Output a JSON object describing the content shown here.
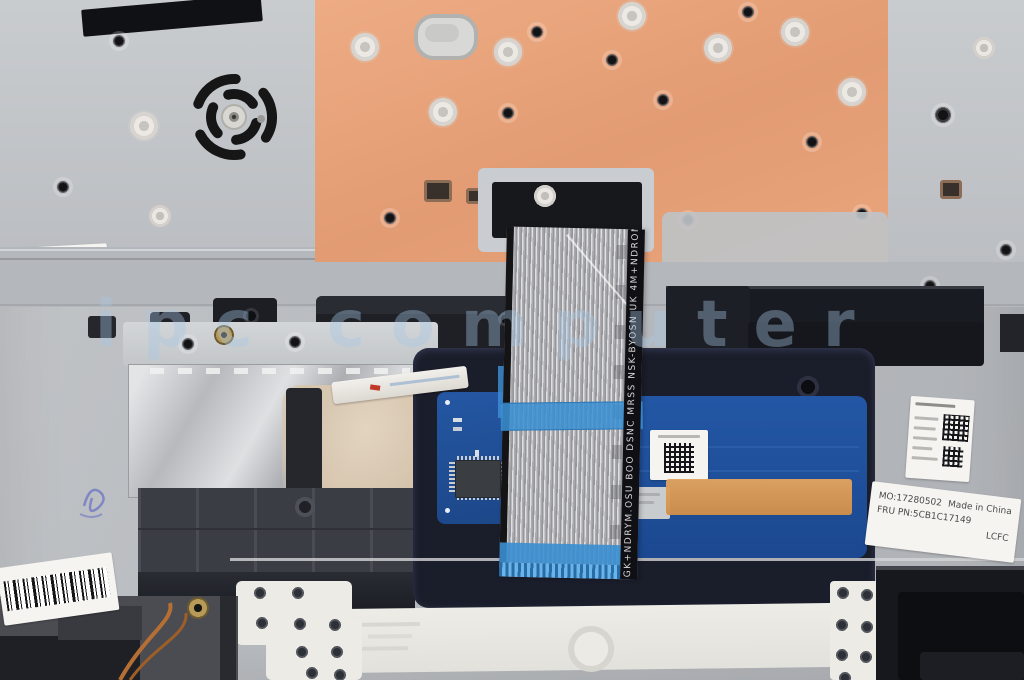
{
  "labels": {
    "watermark": "ipc computer",
    "ribbon_cable_text": "GK+NDRYM.OSU BOO DSNC MRSS NSK-BYOSN UK 4M+NDROM.OSU",
    "fru_label": {
      "mo_number": "MO:17280502",
      "origin": "Made in China",
      "fru_pn": "FRU PN:5CB1C17149",
      "vendor": "LCFC"
    }
  },
  "colors": {
    "base_metal": "#b7babe",
    "adhesive_panel_orange": "#e8a37a",
    "touchpad_blue": "#1f4f9a",
    "pcb_blue": "#2257a3",
    "ribbon_tape_blue": "#3c8fd2",
    "kapton_tape_orange": "#dc9c55",
    "chassis_black": "#17181d",
    "label_white": "#f4f3f0",
    "watermark_blue": "#a8c8e6"
  }
}
